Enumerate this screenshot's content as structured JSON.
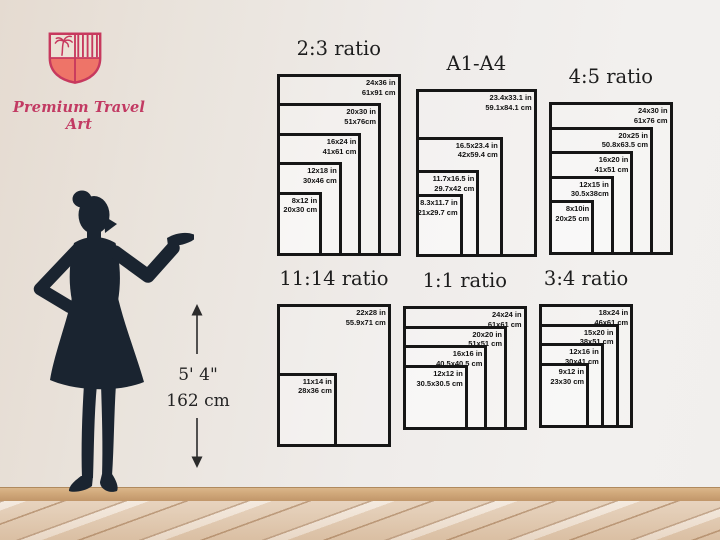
{
  "brand": {
    "name": "Premium Travel Art"
  },
  "logo": {
    "icon": "shield-crest-icon",
    "colors": {
      "outline": "#c7395e",
      "fill": "#ee7468",
      "field": "#ece2d6"
    }
  },
  "figure": {
    "silhouette": "woman-presenting-silhouette",
    "height_imperial": "5' 4\"",
    "height_metric": "162 cm"
  },
  "chart_data": [
    {
      "type": "nested-rectangles",
      "title": "2:3 ratio",
      "sizes": [
        {
          "w_in": 24,
          "h_in": 36,
          "inches": "24x36 in",
          "cm": "61x91 cm"
        },
        {
          "w_in": 20,
          "h_in": 30,
          "inches": "20x30 in",
          "cm": "51x76cm"
        },
        {
          "w_in": 16,
          "h_in": 24,
          "inches": "16x24 in",
          "cm": "41x61 cm"
        },
        {
          "w_in": 12,
          "h_in": 18,
          "inches": "12x18 in",
          "cm": "30x46 cm"
        },
        {
          "w_in": 8,
          "h_in": 12,
          "inches": "8x12 in",
          "cm": "20x30 cm"
        }
      ]
    },
    {
      "type": "nested-rectangles",
      "title": "A1-A4",
      "sizes": [
        {
          "w_in": 23.4,
          "h_in": 33.1,
          "inches": "23.4x33.1 in",
          "cm": "59.1x84.1 cm"
        },
        {
          "w_in": 16.5,
          "h_in": 23.4,
          "inches": "16.5x23.4 in",
          "cm": "42x59.4 cm"
        },
        {
          "w_in": 11.7,
          "h_in": 16.5,
          "inches": "11.7x16.5 in",
          "cm": "29.7x42 cm"
        },
        {
          "w_in": 8.3,
          "h_in": 11.7,
          "inches": "8.3x11.7 in",
          "cm": "21x29.7 cm"
        }
      ]
    },
    {
      "type": "nested-rectangles",
      "title": "4:5 ratio",
      "sizes": [
        {
          "w_in": 24,
          "h_in": 30,
          "inches": "24x30 in",
          "cm": "61x76 cm"
        },
        {
          "w_in": 20,
          "h_in": 25,
          "inches": "20x25 in",
          "cm": "50.8x63.5 cm"
        },
        {
          "w_in": 16,
          "h_in": 20,
          "inches": "16x20 in",
          "cm": "41x51 cm"
        },
        {
          "w_in": 12,
          "h_in": 15,
          "inches": "12x15 in",
          "cm": "30.5x38cm"
        },
        {
          "w_in": 8,
          "h_in": 10,
          "inches": "8x10in",
          "cm": "20x25 cm"
        }
      ]
    },
    {
      "type": "nested-rectangles",
      "title": "11:14 ratio",
      "sizes": [
        {
          "w_in": 22,
          "h_in": 28,
          "inches": "22x28 in",
          "cm": "55.9x71 cm"
        },
        {
          "w_in": 11,
          "h_in": 14,
          "inches": "11x14 in",
          "cm": "28x36 cm"
        }
      ]
    },
    {
      "type": "nested-rectangles",
      "title": "1:1 ratio",
      "sizes": [
        {
          "w_in": 24,
          "h_in": 24,
          "inches": "24x24 in",
          "cm": "61x61 cm"
        },
        {
          "w_in": 20,
          "h_in": 20,
          "inches": "20x20 in",
          "cm": "51x51 cm"
        },
        {
          "w_in": 16,
          "h_in": 16,
          "inches": "16x16 in",
          "cm": "40.5x40.5 cm"
        },
        {
          "w_in": 12,
          "h_in": 12,
          "inches": "12x12 in",
          "cm": "30.5x30.5 cm"
        }
      ]
    },
    {
      "type": "nested-rectangles",
      "title": "3:4 ratio",
      "sizes": [
        {
          "w_in": 18,
          "h_in": 24,
          "inches": "18x24 in",
          "cm": "46x61 cm"
        },
        {
          "w_in": 15,
          "h_in": 20,
          "inches": "15x20 in",
          "cm": "38x51 cm"
        },
        {
          "w_in": 12,
          "h_in": 16,
          "inches": "12x16 in",
          "cm": "30x41 cm"
        },
        {
          "w_in": 9,
          "h_in": 12,
          "inches": "9x12 in",
          "cm": "23x30 cm"
        }
      ]
    }
  ]
}
